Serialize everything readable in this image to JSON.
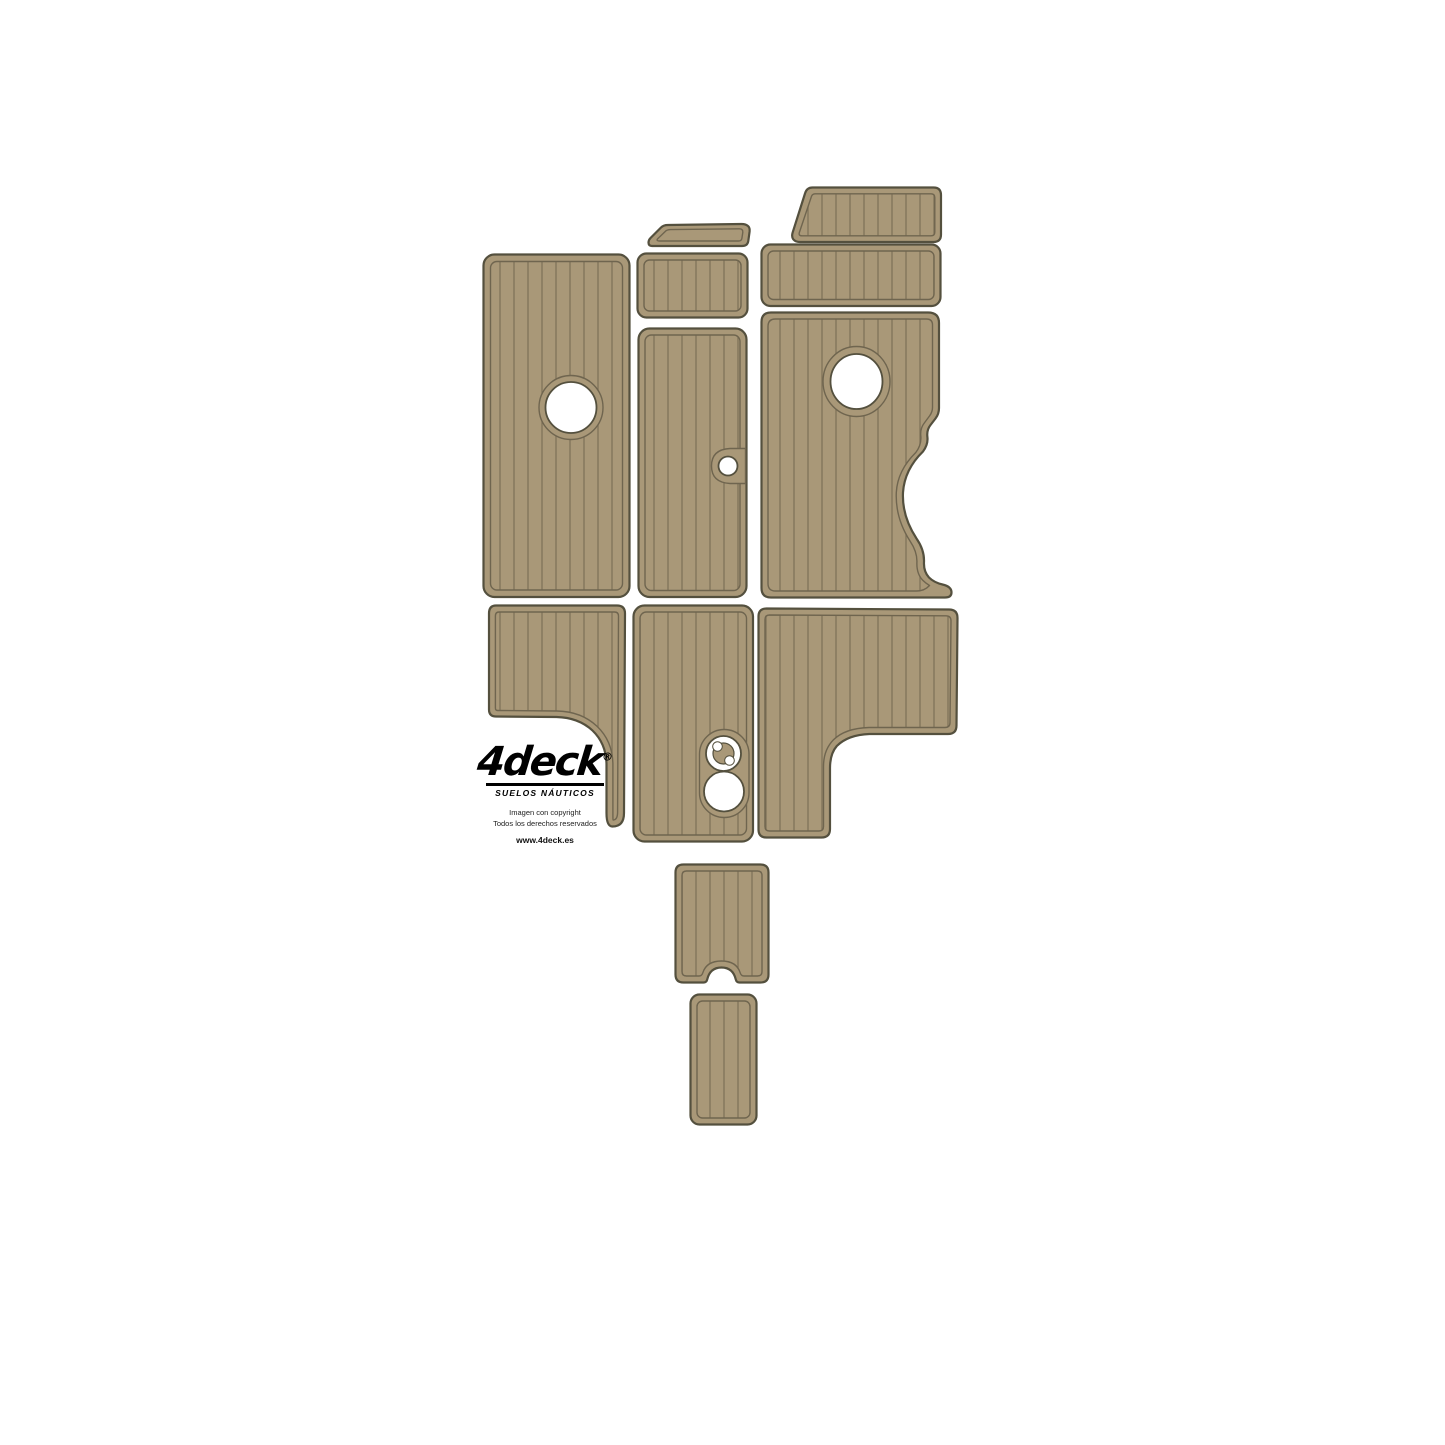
{
  "branding": {
    "logo_text": "4deck",
    "logo_registered": "®",
    "tagline": "SUELOS NÁUTICOS",
    "copyright_line1": "Imagen con copyright",
    "copyright_line2": "Todos los derechos reservados",
    "website": "www.4deck.es"
  },
  "colors": {
    "background": "#ffffff",
    "pad_fill": "#a99878",
    "plank_line": "#80735a",
    "outline": "#54503e",
    "inner_line": "#6f654f",
    "hole_fill": "#ffffff"
  },
  "pads": [
    {
      "id": "wedge-pad-top",
      "description": "small wedge pad, top center"
    },
    {
      "id": "trapezoid-pad-top-right",
      "description": "trapezoid pad, top right"
    },
    {
      "id": "large-left-pad",
      "description": "large rectangular pad with round cutout"
    },
    {
      "id": "small-center-pad",
      "description": "small rectangular pad, center"
    },
    {
      "id": "wide-right-pad",
      "description": "wide shallow rectangular pad, right"
    },
    {
      "id": "tall-center-pad",
      "description": "tall rectangular pad with edge hole"
    },
    {
      "id": "scalloped-right-pad",
      "description": "large pad with round cutout and scalloped right edge"
    },
    {
      "id": "tailed-left-pad",
      "description": "rectangular pad with narrow tail, lower left"
    },
    {
      "id": "hatch-center-pad",
      "description": "tall pad with latch and round cutouts"
    },
    {
      "id": "l-shaped-right-pad",
      "description": "L-shaped pad, lower right"
    },
    {
      "id": "notched-step-pad",
      "description": "small pad with bottom notch"
    },
    {
      "id": "small-bottom-pad",
      "description": "small rectangular pad, bottom"
    }
  ]
}
